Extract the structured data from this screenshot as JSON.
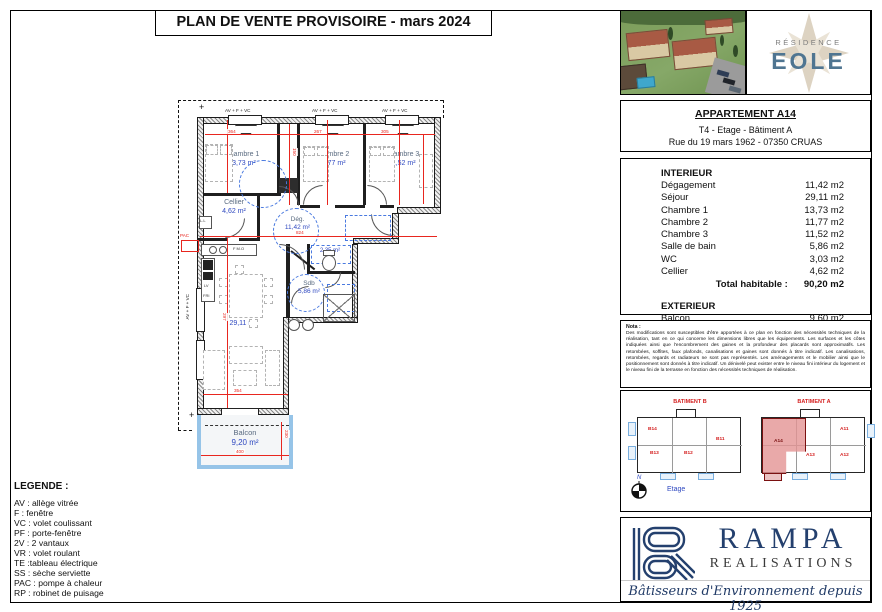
{
  "title": "PLAN DE VENTE PROVISOIRE - mars 2024",
  "eole": {
    "residence": "RÉSIDENCE",
    "name": "EOLE"
  },
  "apartment": {
    "title": "APPARTEMENT A14",
    "type_line": "T4 - Etage - Bâtiment A",
    "address_line": "Rue du 19 mars 1962 - 07350 CRUAS"
  },
  "areas": {
    "interior_title": "INTERIEUR",
    "rows": [
      {
        "label": "Dégagement",
        "value": "11,42 m2"
      },
      {
        "label": "Séjour",
        "value": "29,11 m2"
      },
      {
        "label": "Chambre 1",
        "value": "13,73 m2"
      },
      {
        "label": "Chambre 2",
        "value": "11,77 m2"
      },
      {
        "label": "Chambre 3",
        "value": "11,52 m2"
      },
      {
        "label": "Salle de bain",
        "value": "5,86 m2"
      },
      {
        "label": "WC",
        "value": "3,03 m2"
      },
      {
        "label": "Cellier",
        "value": "4,62 m2"
      }
    ],
    "total_label": "Total habitable :",
    "total_value": "90,20 m2",
    "exterior_title": "EXTERIEUR",
    "ext_rows": [
      {
        "label": "Balcon",
        "value": "9,60 m2"
      }
    ],
    "ext_total_label": "Total extérieur :",
    "ext_total_value": "9,60 m2"
  },
  "nota": {
    "title": "Nota :",
    "body": "Des modifications sont susceptibles d'être apportées à ce plan en fonction des nécessités techniques de la réalisation, tant en ce qui concerne les dimensions libres que les équipements. Les surfaces et les côtes indiquées ainsi que l'encombrement des gaines et la profondeur des placards sont approximatifs. Les retombées, soffites, faux plafonds, canalisations et gaines sont donnés à titre indicatif. Les canalisations, retombées, regards et radiateurs ne sont pas représentés. Les aménagements et le mobilier ainsi que le positionnement sont donnés à titre indicatif. Un dénivelé peut exister entre le niveau fini intérieur du logement et le niveau fini de la terrasse en fonction des nécessités techniques de réalisation."
  },
  "keyplan": {
    "b": {
      "label": "BATIMENT B",
      "units": [
        "B14",
        "B11",
        "B13",
        "B12"
      ]
    },
    "a": {
      "label": "BATIMENT A",
      "units": [
        "A11",
        "A14",
        "A13",
        "A12"
      ]
    },
    "north": "N",
    "floor": "Etage"
  },
  "rampa": {
    "name": "RAMPA",
    "subtitle": "REALISATIONS",
    "tagline": "Bâtisseurs d'Environnement depuis 1925"
  },
  "legend": {
    "title": "LEGENDE :",
    "items": [
      "AV : allège vitrée",
      "F : fenêtre",
      "VC : volet coulissant",
      "PF : porte-fenêtre",
      "2V : 2 vantaux",
      "VR : volet roulant",
      "TE  :tableau électrique",
      "SS : sèche serviette",
      "PAC : pompe à chaleur",
      "RP : robinet de puisage"
    ]
  },
  "plan": {
    "rooms": {
      "chambre1": {
        "name": "Chambre 1",
        "area": "13,73 m²"
      },
      "chambre2": {
        "name": "Chambre 2",
        "area": "11,77 m²"
      },
      "chambre3": {
        "name": "Chambre 3",
        "area": "11,52 m²"
      },
      "cellier": {
        "name": "Cellier",
        "area": "4,62 m²"
      },
      "degagement": {
        "name": "Dég.",
        "area": "11,42 m²"
      },
      "wc": {
        "name": "WC",
        "area": "2,35 m²"
      },
      "sdb": {
        "name": "Sdb",
        "area": "5,86 m²"
      },
      "sejour": {
        "name": "Séjour",
        "area": "29,11 m²"
      },
      "balcon": {
        "name": "Balcon",
        "area": "9,20 m²"
      }
    },
    "window_label": "AV + F + VC",
    "door_label": "PF+2V+VR",
    "labels": {
      "pac": "PAC",
      "ll": "L.L",
      "lv": "LV",
      "fri": "FRI",
      "fmo": "F M.O"
    },
    "dims": [
      "364",
      "267",
      "305",
      "150",
      "824",
      "297",
      "354",
      "400",
      "230"
    ],
    "colors": {
      "dimension": "#e8261f",
      "room_area": "#2f49c0",
      "room_name": "#5a6b80",
      "balcony": "#96c4e8",
      "highlight": "#e08e8e"
    }
  }
}
